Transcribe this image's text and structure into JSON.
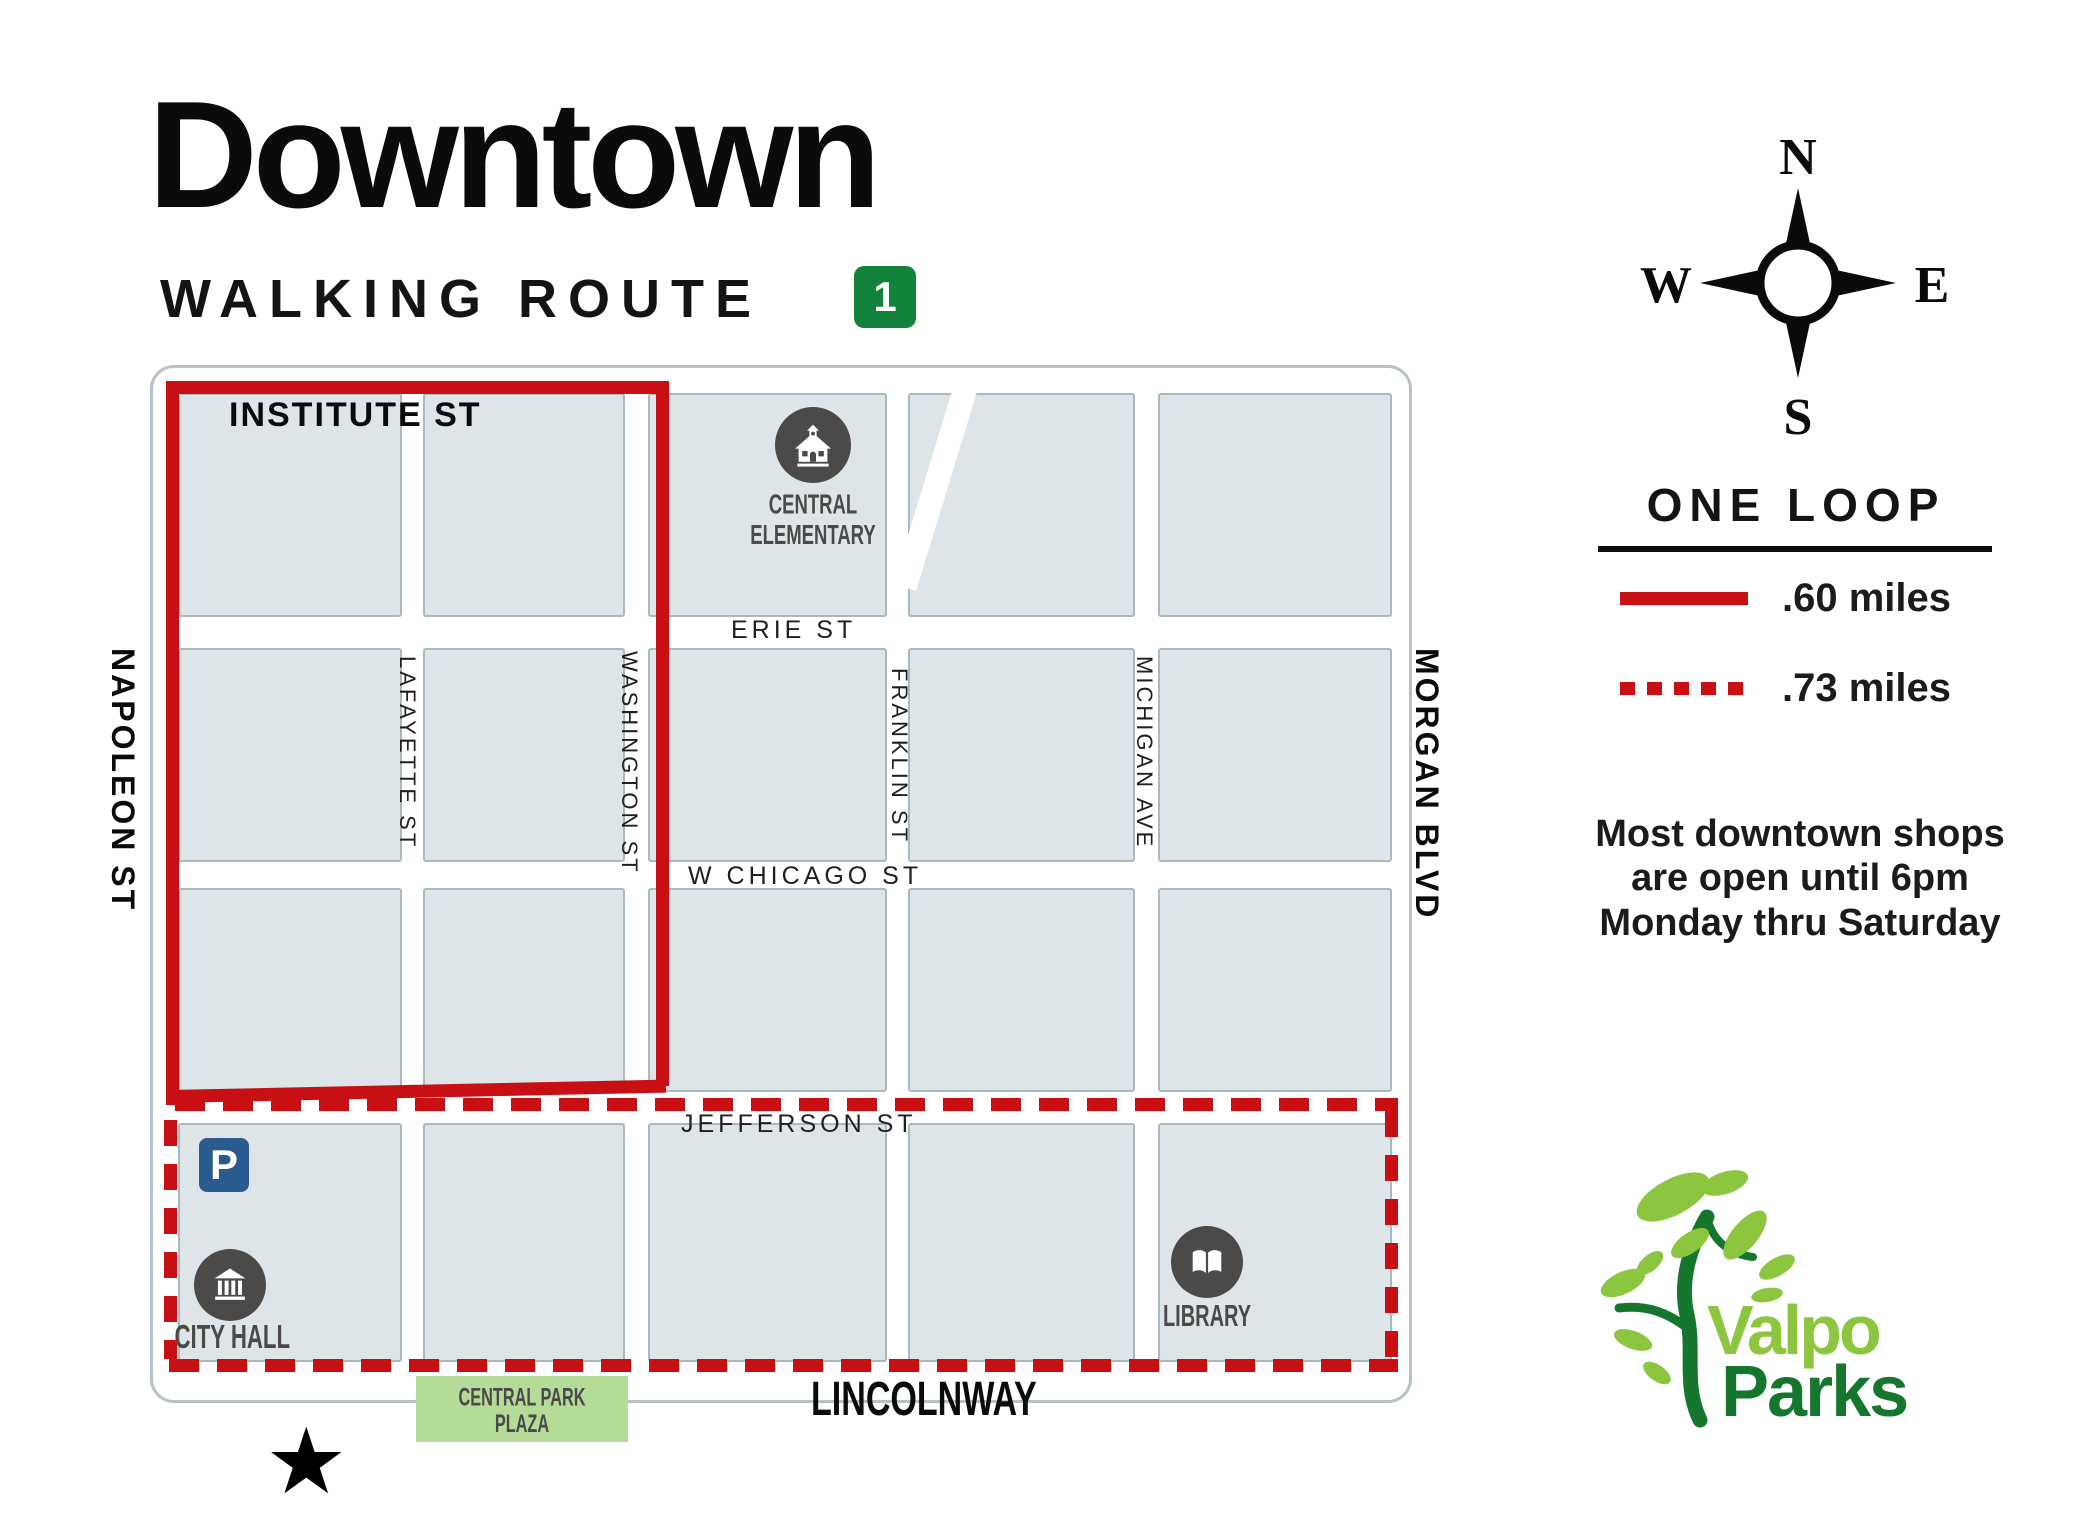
{
  "header": {
    "title": "Downtown",
    "subtitle": "WALKING ROUTE",
    "route_number": "1"
  },
  "compass": {
    "north": "N",
    "south": "S",
    "east": "E",
    "west": "W"
  },
  "legend": {
    "heading": "ONE LOOP",
    "solid_label": ".60 miles",
    "dashed_label": ".73 miles"
  },
  "note": {
    "line1": "Most downtown shops",
    "line2": "are open until 6pm",
    "line3": "Monday thru Saturday"
  },
  "map": {
    "streets": {
      "institute": "INSTITUTE ST",
      "erie": "ERIE ST",
      "chicago": "W CHICAGO ST",
      "jefferson": "JEFFERSON ST",
      "lincolnway": "LINCOLNWAY",
      "napoleon": "NAPOLEON ST",
      "lafayette": "LAFAYETTE ST",
      "washington": "WASHINGTON ST",
      "franklin": "FRANKLIN ST",
      "michigan": "MICHIGAN AVE",
      "morgan": "MORGAN BLVD"
    },
    "pois": {
      "school_line1": "CENTRAL",
      "school_line2": "ELEMENTARY",
      "city_hall": "CITY HALL",
      "library": "LIBRARY",
      "parking": "P",
      "plaza_line1": "CENTRAL PARK",
      "plaza_line2": "PLAZA"
    },
    "start_marker": "★"
  },
  "logo": {
    "word1": "Valpo",
    "word2": "Parks"
  },
  "colors": {
    "route_red": "#c81014",
    "badge_green": "#12813c",
    "block_fill": "#dee5e9",
    "block_border": "#a9b9c0",
    "poi_dark": "#4b4a48",
    "parking_blue": "#2a5b8e",
    "plaza_green": "#b5db99",
    "logo_light_green": "#8cc63e",
    "logo_dark_green": "#15772e"
  }
}
